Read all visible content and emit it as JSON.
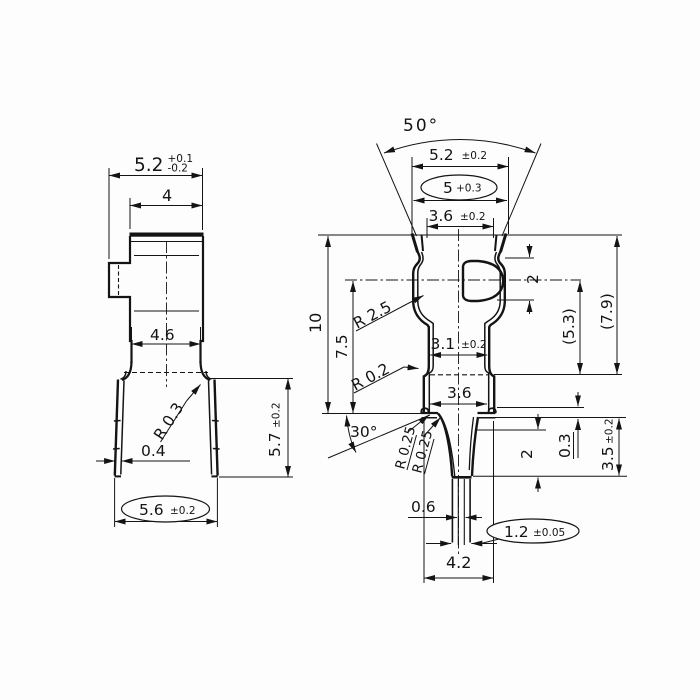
{
  "drawing": {
    "left_view": {
      "dim_width_top": "5.2",
      "dim_width_top_tol_plus": "+0.1",
      "dim_width_top_tol_minus": "-0.2",
      "dim_width_inner": "4",
      "dim_width_mid": "4.6",
      "dim_radius_bend": "R 0.3",
      "dim_leg_thickness": "0.4",
      "dim_width_bottom": "5.6",
      "dim_width_bottom_tol": "±0.2",
      "dim_leg_height": "5.7",
      "dim_leg_height_tol": "±0.2"
    },
    "right_view": {
      "dim_angle_top": "50°",
      "dim_width_outer": "5.2",
      "dim_width_outer_tol": "±0.2",
      "dim_width_oval": "5",
      "dim_width_oval_tol": "+0.3",
      "dim_width_inner_top": "3.6",
      "dim_width_inner_top_tol": "±0.2",
      "dim_radius_shoulder": "R 2.5",
      "dim_dimple_height": "2",
      "dim_height_total": "10",
      "dim_height_upper": "7.5",
      "dim_height_ref_outer": "(7.9)",
      "dim_height_ref_inner": "(5.3)",
      "dim_waist_width": "3.1",
      "dim_waist_width_tol": "±0.2",
      "dim_radius_waist": "R 0.2",
      "dim_leg_width": "3.6",
      "dim_angle_bottom": "30°",
      "dim_radius_flange_left": "R 0.25",
      "dim_radius_flange_right": "R 0.25",
      "dim_tip_gap": "0.6",
      "dim_tip_width": "1.2",
      "dim_tip_width_tol": "±0.05",
      "dim_flange_width": "4.2",
      "dim_step_height": "0.3",
      "dim_pin_height": "3.5",
      "dim_pin_height_tol": "±0.2",
      "dim_taper_depth": "2"
    }
  }
}
